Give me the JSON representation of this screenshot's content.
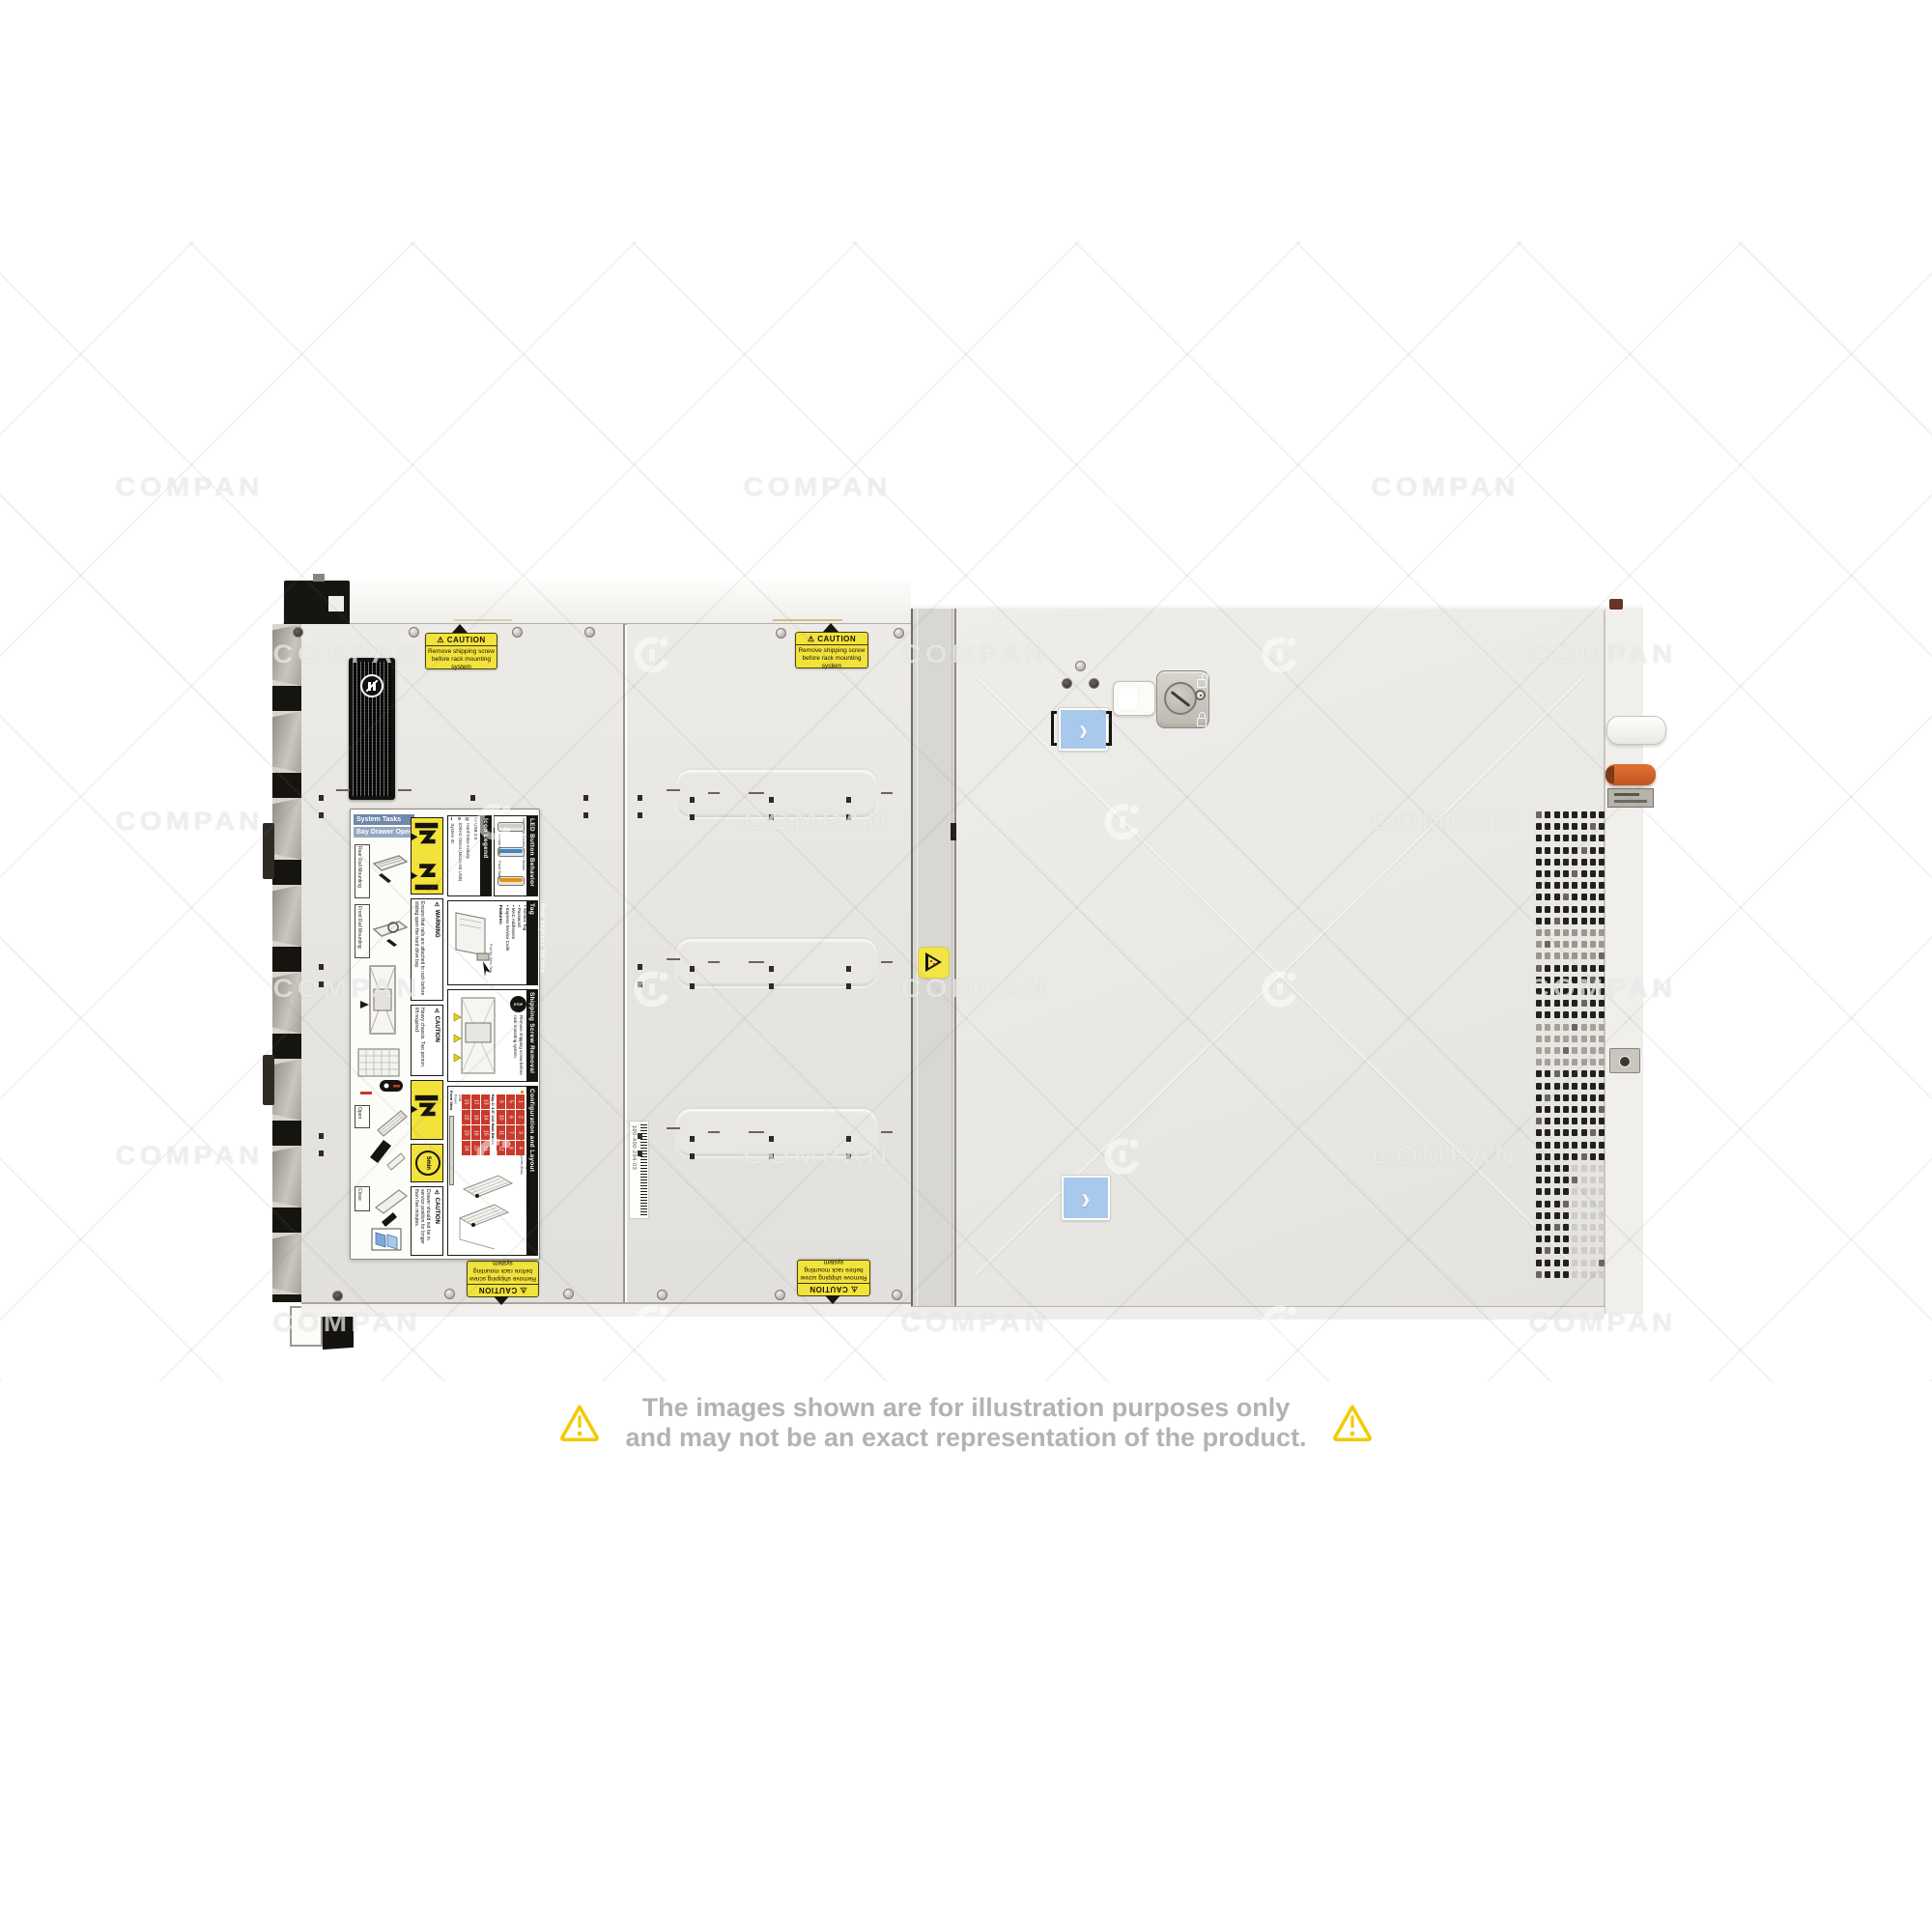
{
  "watermark": {
    "text": "COMPAN"
  },
  "disclaimer": {
    "line1": "The images shown are for illustration purposes only",
    "line2": "and may not be an exact representation of the product."
  },
  "stickers": {
    "caution": {
      "title": "⚠ CAUTION",
      "line1": "Remove shipping screw",
      "line2": "before rack mounting system"
    },
    "barcode_label": "100-400-294-03"
  },
  "service_label": {
    "system_tasks": "System Tasks",
    "bay_drawer": "Bay Drawer Operation",
    "rear_rail": "Rear Rail Mounting",
    "front_rail": "Front Rail Mounting",
    "open": "Open",
    "close": "Close",
    "warning_title": "⚠ WARNING",
    "warning_text": "Ensure that rails are attached to rack before sliding open the hard drive bay.",
    "caution_title": "⚠ CAUTION",
    "heavy_text": "Heavy chassis. Two person lift required.",
    "timer_badge": "5min",
    "timer_text": "Drawer should not be in service position for longer than five minutes.",
    "icon_legend": {
      "title": "Icon Legend",
      "items": [
        {
          "glyph": "ℹ",
          "label": "System ID"
        },
        {
          "glyph": "⚙",
          "label": "iDRAC Direct (Micro-AB USB)"
        },
        {
          "glyph": "▤",
          "label": "Hard Drive Activity"
        },
        {
          "glyph": "⬯",
          "label": "USB 2.0"
        }
      ]
    },
    "led": {
      "title": "LED Button Behavior",
      "subtitle": "Standard Control Panel Status",
      "normal": "Normal State",
      "fault": "Fault State"
    },
    "service_tag": {
      "title": "Rear Express Service Tag",
      "features_title": "Features:",
      "features": [
        "• Service Tag",
        "• Password",
        "• MAC Addresses",
        "• Express Service Code"
      ],
      "pull": "Pull for Serv Tag"
    },
    "shipping": {
      "title": "Shipping Screw Removal",
      "stop": "STOP",
      "text": "Remove shipping screw before rack mounting system."
    },
    "config": {
      "title": "Configuration and Layout",
      "legend1": "Touchpoints (Amber)",
      "legend2": "Cold Static Touchpoints (Blue)",
      "front_view": "Front View",
      "bay1_label": "Bay 1: 3.5\" x12 Hard Drives",
      "bay2_label": "Bay 2: 3.5\" x12 Hard Drives",
      "bay1_numbers": [
        1,
        2,
        3,
        4,
        5,
        6,
        7,
        8,
        9,
        10,
        11,
        12
      ],
      "bay2_numbers": [
        13,
        14,
        15,
        16,
        17,
        18,
        19,
        20,
        21,
        22,
        23,
        24
      ],
      "front_items": [
        "System ID / Status Light Bar",
        "Hard Drive Activity",
        "iDRAC Direct (Micro-AB USB)",
        "USB",
        "Power"
      ]
    }
  }
}
